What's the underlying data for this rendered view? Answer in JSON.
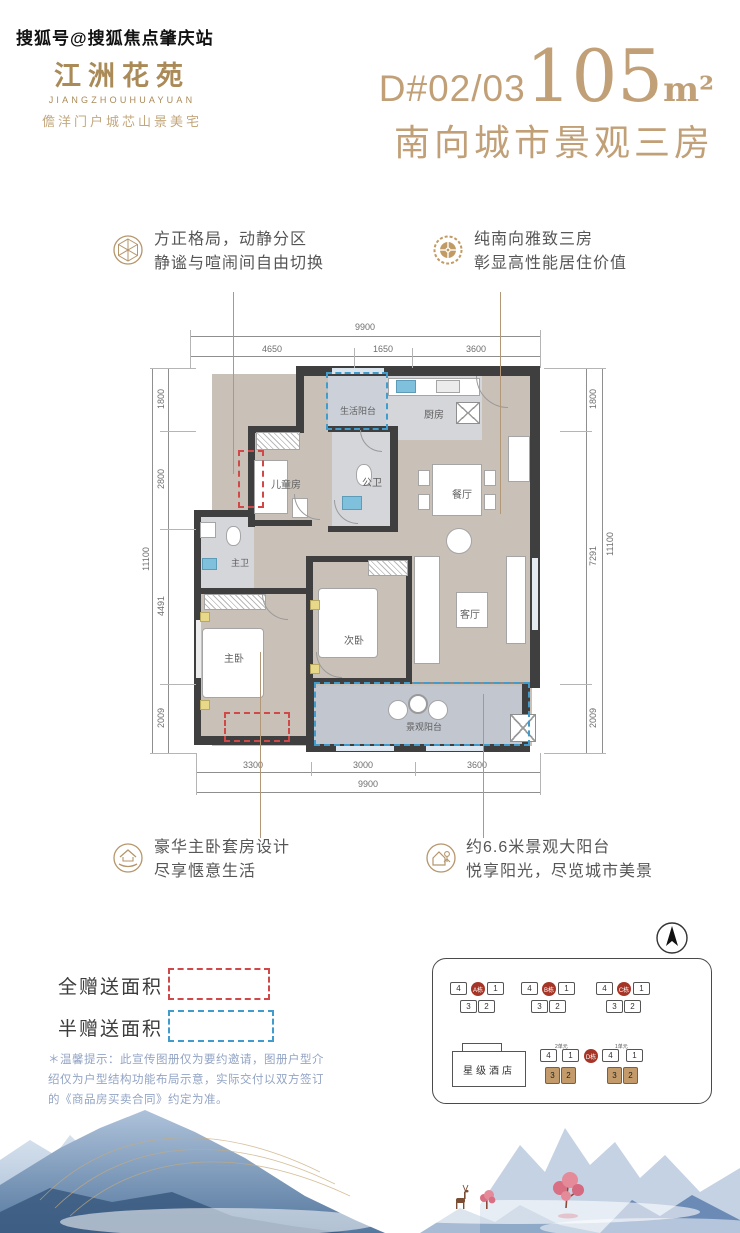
{
  "watermark": "搜狐号@搜狐焦点肇庆站",
  "logo": {
    "name": "江洲花苑",
    "latin": "JIANGZHOUHUAYUAN",
    "tagline": "儋洋门户城芯山景美宅"
  },
  "title": {
    "unit_code": "D#02/03",
    "area_value": "105",
    "area_unit": "m²",
    "subtitle": "南向城市景观三房"
  },
  "callouts": {
    "top_left": {
      "line1": "方正格局，动静分区",
      "line2": "静谧与喧闹间自由切换"
    },
    "top_right": {
      "line1": "纯南向雅致三房",
      "line2": "彰显高性能居住价值"
    },
    "bottom_left": {
      "line1": "豪华主卧套房设计",
      "line2": "尽享惬意生活"
    },
    "bottom_right": {
      "line1": "约6.6米景观大阳台",
      "line2": "悦享阳光，尽览城市美景"
    }
  },
  "floorplan": {
    "rooms": {
      "life_balcony": "生活阳台",
      "kitchen": "厨房",
      "children": "儿童房",
      "guest_bath": "公卫",
      "dining": "餐厅",
      "master_bath": "主卫",
      "master_bed": "主卧",
      "second_bed": "次卧",
      "living": "客厅",
      "view_balcony": "景观阳台"
    },
    "dims_top": {
      "total": "9900",
      "segments": [
        "4650",
        "1650",
        "3600"
      ]
    },
    "dims_bottom": {
      "total": "9900",
      "segments": [
        "3300",
        "3000",
        "3600"
      ]
    },
    "dims_left": {
      "total": "11100",
      "segments": [
        "1800",
        "2800",
        "4491",
        "2009"
      ]
    },
    "dims_right": {
      "total": "11100",
      "segments": [
        "1800",
        "7291",
        "2009"
      ]
    }
  },
  "legend": {
    "full_gift": "全赠送面积",
    "half_gift": "半赠送面积"
  },
  "disclaimer": {
    "line1": "＊温馨提示：此宣传图册仅为要约邀请，图册户型介",
    "line2": "绍仅为户型结构功能布局示意，实际交付以双方签订",
    "line3": "的《商品房买卖合同》约定为准。"
  },
  "siteplan": {
    "hotel": "星级酒店",
    "buildings": [
      {
        "name": "A栋"
      },
      {
        "name": "B栋"
      },
      {
        "name": "C栋"
      },
      {
        "name": "D栋"
      }
    ],
    "unit_numbers": {
      "n1": "1",
      "n2": "2",
      "n3": "3",
      "n4": "4"
    },
    "d_sections": {
      "left": "2单元",
      "right": "1单元"
    }
  },
  "colors": {
    "brand_gold": "#aa8a57",
    "title_gold": "#c1a077",
    "red_dash": "#d04848",
    "blue_dash": "#3f9ccd",
    "wall": "#3f3f3f",
    "highlight_unit": "#c39b6a"
  }
}
